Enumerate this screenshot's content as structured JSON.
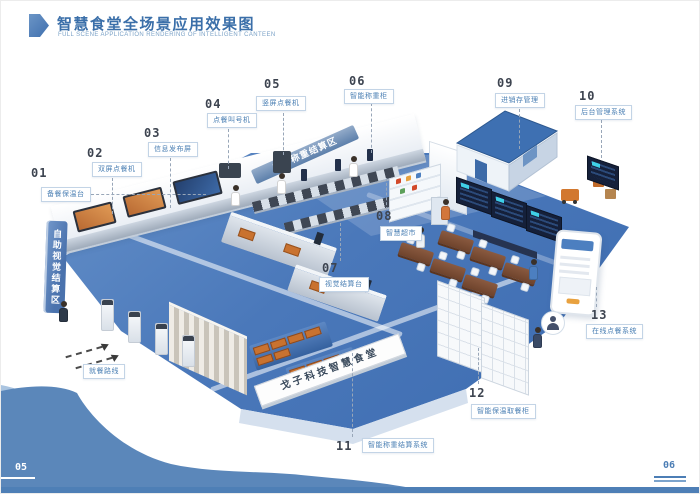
{
  "header": {
    "title": "智慧食堂全场景应用效果图",
    "subtitle": "FULL SCENE APPLICATION RENDERING OF INTELLIGENT CANTEEN"
  },
  "colors": {
    "accent_blue": "#3b6fa9",
    "floor_blue": "#4a78ba",
    "wave_blue": "#5b87ba",
    "label_blue": "#4c80b4",
    "food_orange": "#c9722f"
  },
  "banners": {
    "weigh_zone": "自助称重结算区",
    "vision_zone": "自助视觉结算区",
    "canteen_name": "戈子科技智慧食堂"
  },
  "route": {
    "label": "就餐路线"
  },
  "callouts": [
    {
      "num": "01",
      "label": "备餐保温台"
    },
    {
      "num": "02",
      "label": "双屏点餐机"
    },
    {
      "num": "03",
      "label": "信息发布屏"
    },
    {
      "num": "04",
      "label": "点餐叫号机"
    },
    {
      "num": "05",
      "label": "竖屏点餐机"
    },
    {
      "num": "06",
      "label": "智能称重柜"
    },
    {
      "num": "07",
      "label": "视觉结算台"
    },
    {
      "num": "08",
      "label": "智慧超市"
    },
    {
      "num": "09",
      "label": "进销存管理"
    },
    {
      "num": "10",
      "label": "后台管理系统"
    },
    {
      "num": "11",
      "label": "智能称重结算系统"
    },
    {
      "num": "12",
      "label": "智能保温取餐柜"
    },
    {
      "num": "13",
      "label": "在线点餐系统"
    }
  ],
  "footer": {
    "page_left": "05",
    "page_right": "06"
  }
}
